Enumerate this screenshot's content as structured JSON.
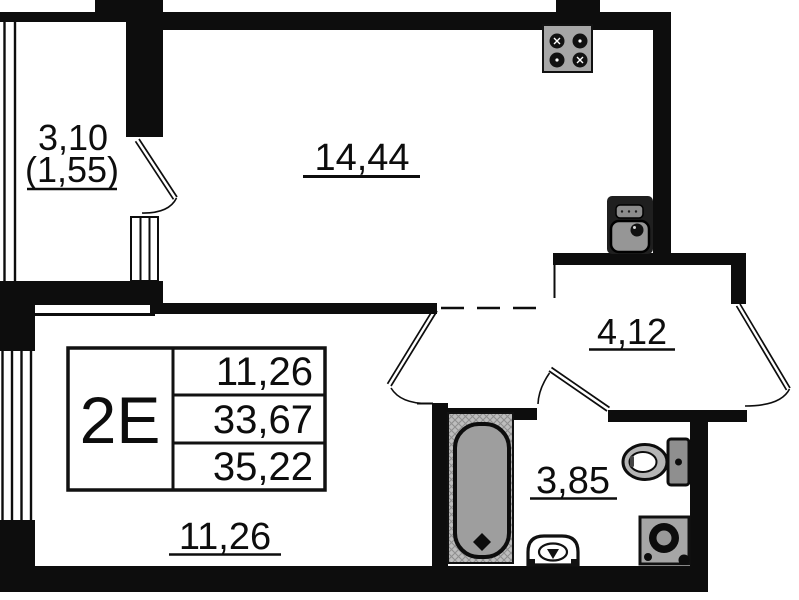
{
  "rooms": {
    "balcony": {
      "area": "3,10",
      "area_coeff": "(1,55)"
    },
    "living": {
      "area": "14,44"
    },
    "hall": {
      "area": "4,12"
    },
    "bathroom": {
      "area": "3,85"
    },
    "bedroom": {
      "area": "11,26"
    }
  },
  "info_table": {
    "unit_type": "2E",
    "values": [
      "11,26",
      "33,67",
      "35,22"
    ]
  },
  "fixtures": [
    "stove-icon",
    "kitchen-sink-icon",
    "bathtub-icon",
    "washbasin-icon",
    "toilet-icon",
    "washing-machine-icon"
  ],
  "colors": {
    "walls": "#0d0d0d",
    "fixture_gray": "#a6a6a6",
    "background": "#ffffff"
  }
}
